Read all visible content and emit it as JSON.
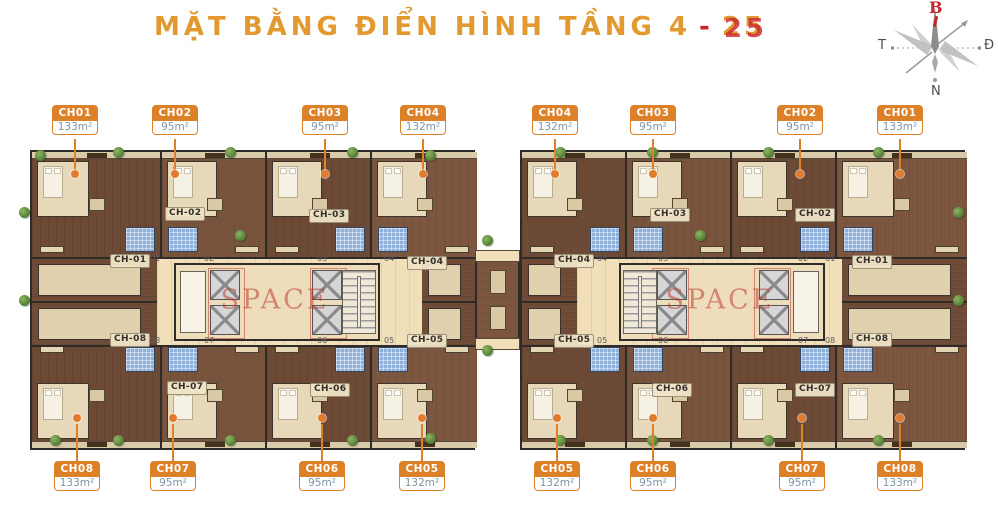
{
  "title": {
    "main": "MẶT BẰNG ĐIỂN HÌNH TẦNG 4",
    "dash": "-",
    "floor": "25"
  },
  "compass": {
    "north": "B",
    "south": "N",
    "west": "T",
    "east": "Đ"
  },
  "watermark": {
    "text": "SPACE"
  },
  "colors": {
    "accent_orange": "#DD8128",
    "title_orange": "#E2992F",
    "accent_red": "#C9242B",
    "wall": "#2e2b28",
    "bath_blue": "#8fb0d8",
    "corridor_beige": "#f1dfba",
    "wood": "#7c563f"
  },
  "unit_tags": {
    "top": [
      {
        "id": "CH01",
        "area": "133m²",
        "x": 75
      },
      {
        "id": "CH02",
        "area": "95m²",
        "x": 175
      },
      {
        "id": "CH03",
        "area": "95m²",
        "x": 325
      },
      {
        "id": "CH04",
        "area": "132m²",
        "x": 423
      },
      {
        "id": "CH04",
        "area": "132m²",
        "x": 555
      },
      {
        "id": "CH03",
        "area": "95m²",
        "x": 653
      },
      {
        "id": "CH02",
        "area": "95m²",
        "x": 800
      },
      {
        "id": "CH01",
        "area": "133m²",
        "x": 900
      }
    ],
    "bottom": [
      {
        "id": "CH08",
        "area": "133m²",
        "x": 77
      },
      {
        "id": "CH07",
        "area": "95m²",
        "x": 173
      },
      {
        "id": "CH06",
        "area": "95m²",
        "x": 322
      },
      {
        "id": "CH05",
        "area": "132m²",
        "x": 422
      },
      {
        "id": "CH05",
        "area": "132m²",
        "x": 557
      },
      {
        "id": "CH06",
        "area": "95m²",
        "x": 653
      },
      {
        "id": "CH07",
        "area": "95m²",
        "x": 802
      },
      {
        "id": "CH08",
        "area": "133m²",
        "x": 900
      }
    ]
  },
  "blocks": [
    {
      "name": "left-block",
      "x": 30,
      "y": 150,
      "w": 445,
      "h": 300,
      "mirrored": false,
      "corridor": {
        "x0": 125,
        "x1": 390
      },
      "core": {
        "x0": 142,
        "x1": 348
      },
      "side_strips": [
        {
          "x0": 0,
          "x1": 125
        },
        {
          "x0": 390,
          "x1": 445
        }
      ],
      "apartments_top": [
        {
          "label": "CH-01",
          "x0": 0,
          "x1": 130,
          "lx": 78,
          "ly": 102
        },
        {
          "label": "CH-02",
          "x0": 130,
          "x1": 235,
          "lx": 133,
          "ly": 55
        },
        {
          "label": "CH-03",
          "x0": 235,
          "x1": 340,
          "lx": 277,
          "ly": 57
        },
        {
          "label": "CH-04",
          "x0": 340,
          "x1": 445,
          "lx": 375,
          "ly": 104
        }
      ],
      "apartments_bottom": [
        {
          "label": "CH-08",
          "x0": 0,
          "x1": 130,
          "lx": 78,
          "ly": 181
        },
        {
          "label": "CH-07",
          "x0": 130,
          "x1": 235,
          "lx": 135,
          "ly": 229
        },
        {
          "label": "CH-06",
          "x0": 235,
          "x1": 340,
          "lx": 278,
          "ly": 231
        },
        {
          "label": "CH-05",
          "x0": 340,
          "x1": 445,
          "lx": 375,
          "ly": 182
        }
      ],
      "doors": [
        {
          "n": "01",
          "x": 118,
          "y": 103
        },
        {
          "n": "02",
          "x": 172,
          "y": 103
        },
        {
          "n": "03",
          "x": 285,
          "y": 103
        },
        {
          "n": "04",
          "x": 352,
          "y": 103
        },
        {
          "n": "08",
          "x": 118,
          "y": 185
        },
        {
          "n": "07",
          "x": 172,
          "y": 185
        },
        {
          "n": "06",
          "x": 285,
          "y": 185
        },
        {
          "n": "05",
          "x": 352,
          "y": 185
        }
      ]
    },
    {
      "name": "right-block",
      "x": 520,
      "y": 150,
      "w": 445,
      "h": 300,
      "mirrored": true,
      "corridor": {
        "x0": 55,
        "x1": 320
      },
      "core": {
        "x0": 97,
        "x1": 303
      },
      "side_strips": [
        {
          "x0": 0,
          "x1": 55
        },
        {
          "x0": 320,
          "x1": 445
        }
      ],
      "apartments_top": [
        {
          "label": "CH-04",
          "x0": 0,
          "x1": 105,
          "lx": 32,
          "ly": 102
        },
        {
          "label": "CH-03",
          "x0": 105,
          "x1": 210,
          "lx": 128,
          "ly": 56
        },
        {
          "label": "CH-02",
          "x0": 210,
          "x1": 315,
          "lx": 273,
          "ly": 56
        },
        {
          "label": "CH-01",
          "x0": 315,
          "x1": 445,
          "lx": 330,
          "ly": 103
        }
      ],
      "apartments_bottom": [
        {
          "label": "CH-05",
          "x0": 0,
          "x1": 105,
          "lx": 32,
          "ly": 182
        },
        {
          "label": "CH-06",
          "x0": 105,
          "x1": 210,
          "lx": 130,
          "ly": 231
        },
        {
          "label": "CH-07",
          "x0": 210,
          "x1": 315,
          "lx": 273,
          "ly": 231
        },
        {
          "label": "CH-08",
          "x0": 315,
          "x1": 445,
          "lx": 330,
          "ly": 181
        }
      ],
      "doors": [
        {
          "n": "04",
          "x": 75,
          "y": 103
        },
        {
          "n": "03",
          "x": 136,
          "y": 103
        },
        {
          "n": "02",
          "x": 276,
          "y": 103
        },
        {
          "n": "01",
          "x": 303,
          "y": 103
        },
        {
          "n": "05",
          "x": 75,
          "y": 185
        },
        {
          "n": "06",
          "x": 136,
          "y": 185
        },
        {
          "n": "07",
          "x": 276,
          "y": 185
        },
        {
          "n": "08",
          "x": 303,
          "y": 185
        }
      ]
    }
  ],
  "plants": [
    {
      "x": 24,
      "y": 212
    },
    {
      "x": 24,
      "y": 300
    },
    {
      "x": 40,
      "y": 155
    },
    {
      "x": 118,
      "y": 152
    },
    {
      "x": 230,
      "y": 152
    },
    {
      "x": 240,
      "y": 235
    },
    {
      "x": 352,
      "y": 152
    },
    {
      "x": 430,
      "y": 155
    },
    {
      "x": 487,
      "y": 240
    },
    {
      "x": 487,
      "y": 350
    },
    {
      "x": 560,
      "y": 152
    },
    {
      "x": 652,
      "y": 152
    },
    {
      "x": 700,
      "y": 235
    },
    {
      "x": 768,
      "y": 152
    },
    {
      "x": 878,
      "y": 152
    },
    {
      "x": 958,
      "y": 212
    },
    {
      "x": 958,
      "y": 300
    },
    {
      "x": 118,
      "y": 440
    },
    {
      "x": 230,
      "y": 440
    },
    {
      "x": 352,
      "y": 440
    },
    {
      "x": 430,
      "y": 438
    },
    {
      "x": 560,
      "y": 440
    },
    {
      "x": 652,
      "y": 440
    },
    {
      "x": 768,
      "y": 440
    },
    {
      "x": 878,
      "y": 440
    },
    {
      "x": 55,
      "y": 440
    }
  ]
}
